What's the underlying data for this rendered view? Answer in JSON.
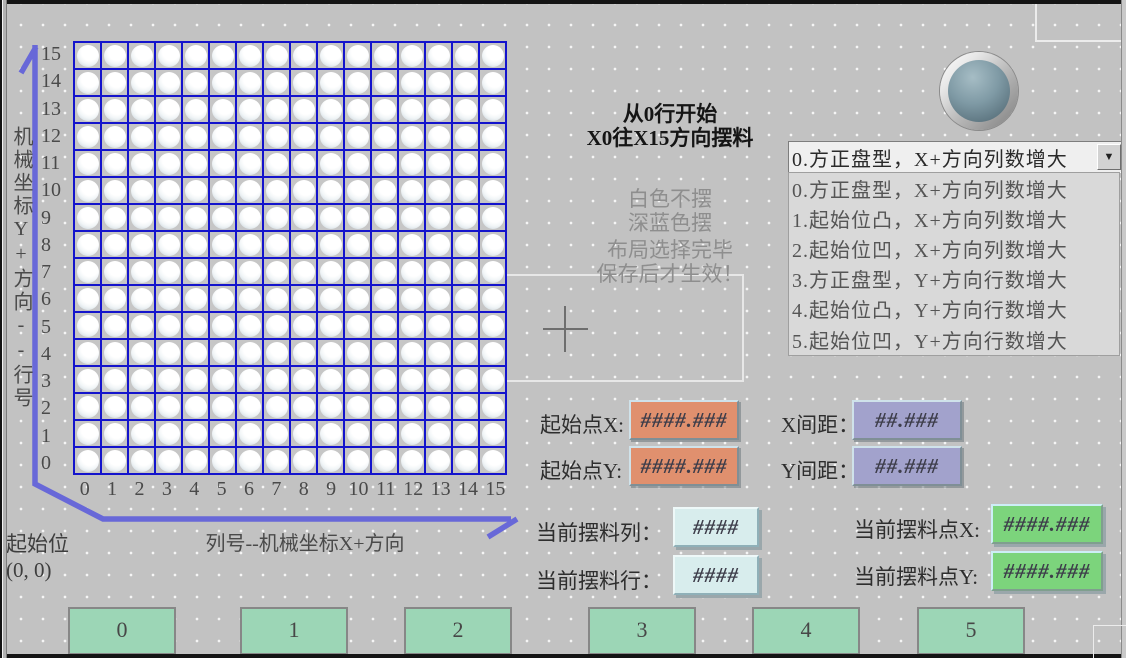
{
  "header": {
    "line1": "从0行开始",
    "line2": "X0往X15方向摆料"
  },
  "notes": {
    "white_rule": "白色不摆",
    "blue_rule": "深蓝色摆",
    "hint1": "布局选择完毕",
    "hint2": "保存后才生效！"
  },
  "grid": {
    "rows": 16,
    "cols": 16,
    "slot_state": "white",
    "row_labels": [
      "15",
      "14",
      "13",
      "12",
      "11",
      "10",
      "9",
      "8",
      "7",
      "6",
      "5",
      "4",
      "3",
      "2",
      "1",
      "0"
    ],
    "col_labels": [
      "0",
      "1",
      "2",
      "3",
      "4",
      "5",
      "6",
      "7",
      "8",
      "9",
      "10",
      "11",
      "12",
      "13",
      "14",
      "15"
    ]
  },
  "axis": {
    "y_label": "机械坐标Y+方向--行号",
    "x_label": "列号--机械坐标X+方向",
    "origin_line1": "起始位",
    "origin_line2": "(0, 0)"
  },
  "layout_select": {
    "selected": "0.方正盘型，X+方向列数增大",
    "dropdown_icon": "▼",
    "options": [
      "0.方正盘型，X+方向列数增大",
      "1.起始位凸，X+方向列数增大",
      "2.起始位凹，X+方向列数增大",
      "3.方正盘型，Y+方向行数增大",
      "4.起始位凸，Y+方向行数增大",
      "5.起始位凹，Y+方向行数增大"
    ]
  },
  "fields": {
    "start_x": {
      "label": "起始点X:",
      "value": "####.###"
    },
    "start_y": {
      "label": "起始点Y:",
      "value": "####.###"
    },
    "x_gap": {
      "label": "X间距：",
      "value": "##.###"
    },
    "y_gap": {
      "label": "Y间距：",
      "value": "##.###"
    },
    "current_col": {
      "label": "当前摆料列：",
      "value": "####"
    },
    "current_row": {
      "label": "当前摆料行：",
      "value": "####"
    },
    "current_point_x": {
      "label": "当前摆料点X:",
      "value": "####.###"
    },
    "current_point_y": {
      "label": "当前摆料点Y:",
      "value": "####.###"
    }
  },
  "buttons": [
    "0",
    "1",
    "2",
    "3",
    "4",
    "5"
  ],
  "colors": {
    "grid_line": "#1414cc",
    "axis": "#6868d8",
    "start_field": "#e0906e",
    "gap_field": "#a2a2cc",
    "counter_field": "#d8eded",
    "point_field": "#7cd47c",
    "page_button": "#9cd6b6",
    "lamp_center": "#7f9aa5"
  }
}
